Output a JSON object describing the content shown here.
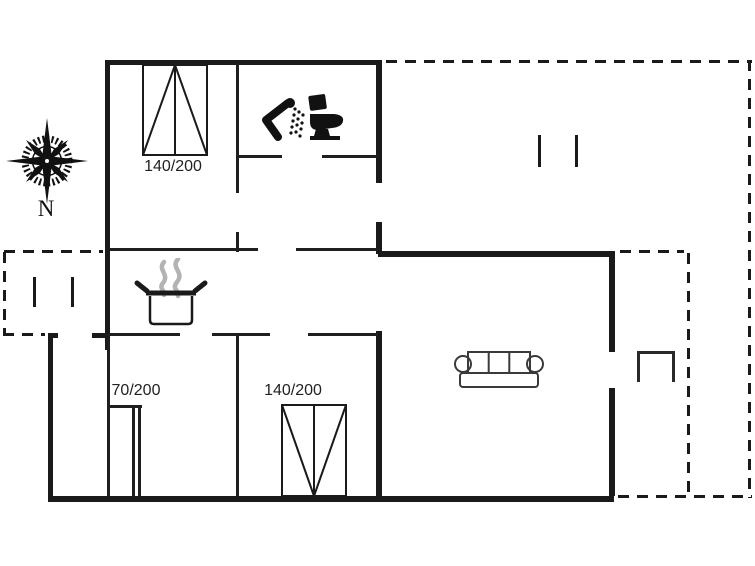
{
  "canvas": {
    "background": "#ffffff",
    "wall_color": "#1a1a1a"
  },
  "compass": {
    "label": "N",
    "icon": "compass-rose"
  },
  "beds": {
    "double_top": {
      "label": "140/200"
    },
    "double_bottom": {
      "label": "140/200"
    },
    "single": {
      "label": "70/200"
    }
  },
  "icons": {
    "bathroom_shower": "shower-head",
    "bathroom_toilet": "toilet",
    "kitchen_stove": "steaming-pot",
    "living_room_sofa": "sofa"
  }
}
